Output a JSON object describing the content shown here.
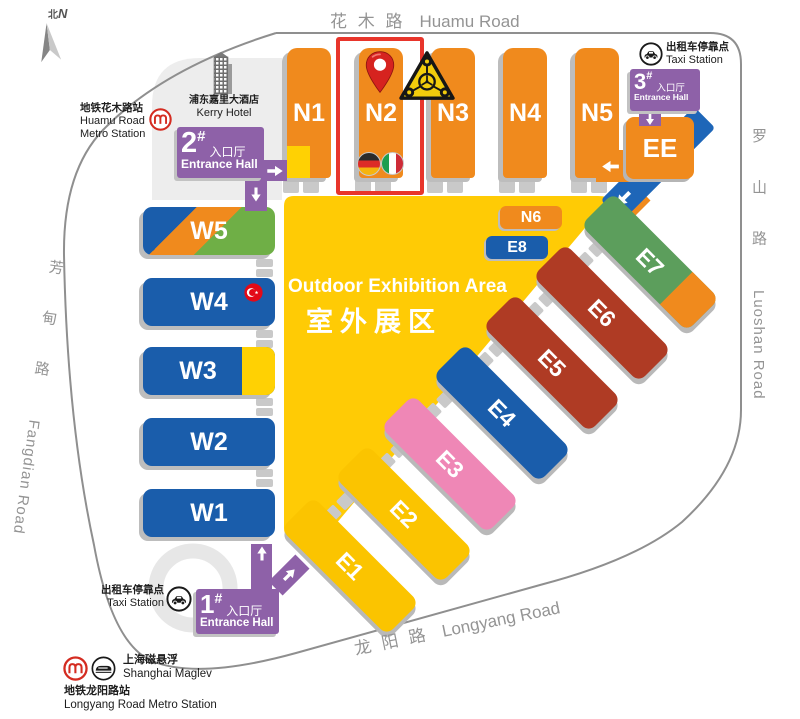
{
  "palette": {
    "orange": "#F08A1D",
    "hall_blue": "#1A5DAB",
    "yellow": "#FFCB05",
    "deep_yellow": "#FBC400",
    "pink": "#EF87B6",
    "brick_red": "#AF3B24",
    "green": "#5C9E5C",
    "lime_green": "#6FAF46",
    "purple": "#8E61A8",
    "band_blue": "#1E66B8",
    "highlight_red": "#E8352B",
    "shadow_gray": "#BDBDBD",
    "road_gray": "#8F8F8F"
  },
  "compass": {
    "zh": "北",
    "en": "N"
  },
  "roads": {
    "huamu": {
      "zh": "花 木 路",
      "en": "Huamu Road"
    },
    "luoshan": {
      "zh": "罗 山 路",
      "en": "Luoshan Road"
    },
    "fangdian": {
      "zh": "芳 甸 路",
      "en": "Fangdian Road"
    },
    "longyang": {
      "zh": "龙 阳 路",
      "en": "Longyang Road"
    }
  },
  "stations": {
    "huamu_metro": {
      "zh": "地铁花木路站",
      "en_l1": "Huamu Road",
      "en_l2": "Metro Station"
    },
    "kerry_hotel": {
      "zh": "浦东嘉里大酒店",
      "en": "Kerry Hotel"
    },
    "taxi_north": {
      "zh": "出租车停靠点",
      "en": "Taxi Station"
    },
    "taxi_south": {
      "zh": "出租车停靠点",
      "en": "Taxi Station"
    },
    "maglev": {
      "zh": "上海磁悬浮",
      "en": "Shanghai Maglev"
    },
    "longyang_metro": {
      "zh": "地铁龙阳路站",
      "en": "Longyang Road Metro Station"
    }
  },
  "entrances": {
    "no1": {
      "num": "1",
      "sup": "#",
      "zh": "入口厅",
      "en": "Entrance Hall"
    },
    "no2": {
      "num": "2",
      "sup": "#",
      "zh": "入口厅",
      "en": "Entrance Hall"
    },
    "no3": {
      "num": "3",
      "sup": "#",
      "zh": "入口厅",
      "en": "Entrance Hall"
    }
  },
  "halls": {
    "n1": "N1",
    "n2": "N2",
    "n3": "N3",
    "n4": "N4",
    "n5": "N5",
    "n6": "N6",
    "w1": "W1",
    "w2": "W2",
    "w3": "W3",
    "w4": "W4",
    "w5": "W5",
    "e1": "E1",
    "e2": "E2",
    "e3": "E3",
    "e4": "E4",
    "e5": "E5",
    "e6": "E6",
    "e7": "E7",
    "e8": "E8",
    "ee": "EE"
  },
  "outdoor": {
    "en": "Outdoor Exhibition Area",
    "zh": "室外展区"
  },
  "highlight": {
    "hall": "N2"
  },
  "icons": {
    "compass": "north-arrow",
    "metro": "shanghai-metro-logo",
    "hotel": "hotel-building",
    "taxi": "taxi-car",
    "maglev": "maglev-train",
    "pin": "location-pin",
    "brand_triangle": "triangle-brand-logo",
    "flag_n2_left": "germany-flag",
    "flag_n2_right": "italy-flag",
    "flag_w4": "turkey-flag",
    "arrows": "direction-arrow"
  }
}
